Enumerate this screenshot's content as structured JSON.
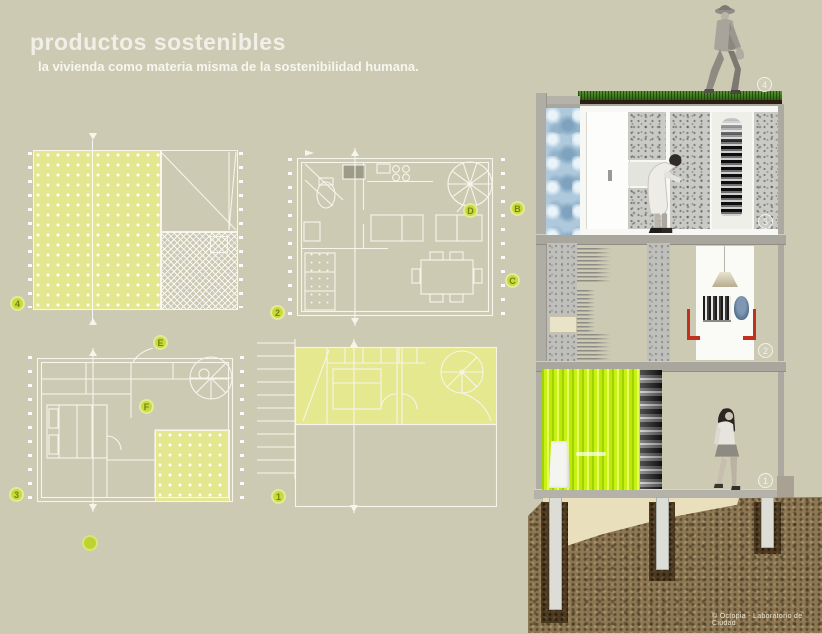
{
  "header": {
    "title": "productos sostenibles",
    "subtitle": "la vivienda como materia misma de la sostenibilidad humana."
  },
  "plans": {
    "p4": {
      "label": "4"
    },
    "p2": {
      "label": "2",
      "marker_b": "B",
      "marker_c": "C",
      "marker_d": "D"
    },
    "p3": {
      "label": "3",
      "marker_e": "E",
      "marker_f": "F"
    },
    "p1": {
      "label": "1"
    }
  },
  "section": {
    "roof_badge": "4",
    "floor3_badge": "3",
    "floor2_badge": "2",
    "floor1_badge": "1"
  },
  "footer": {
    "copyright": "© Octopia - Laboratorio de Ciudad"
  },
  "colors": {
    "background": "#CDCAB3",
    "plan_yellow": "#E4E78F",
    "badge_green": "#C9DA3B",
    "curtain_lime": "#C8F215",
    "accent_red": "#C23020",
    "grass_green": "#3F7D1E",
    "soil_brown": "#8D7854",
    "water_blue": "#AFC9DC"
  }
}
